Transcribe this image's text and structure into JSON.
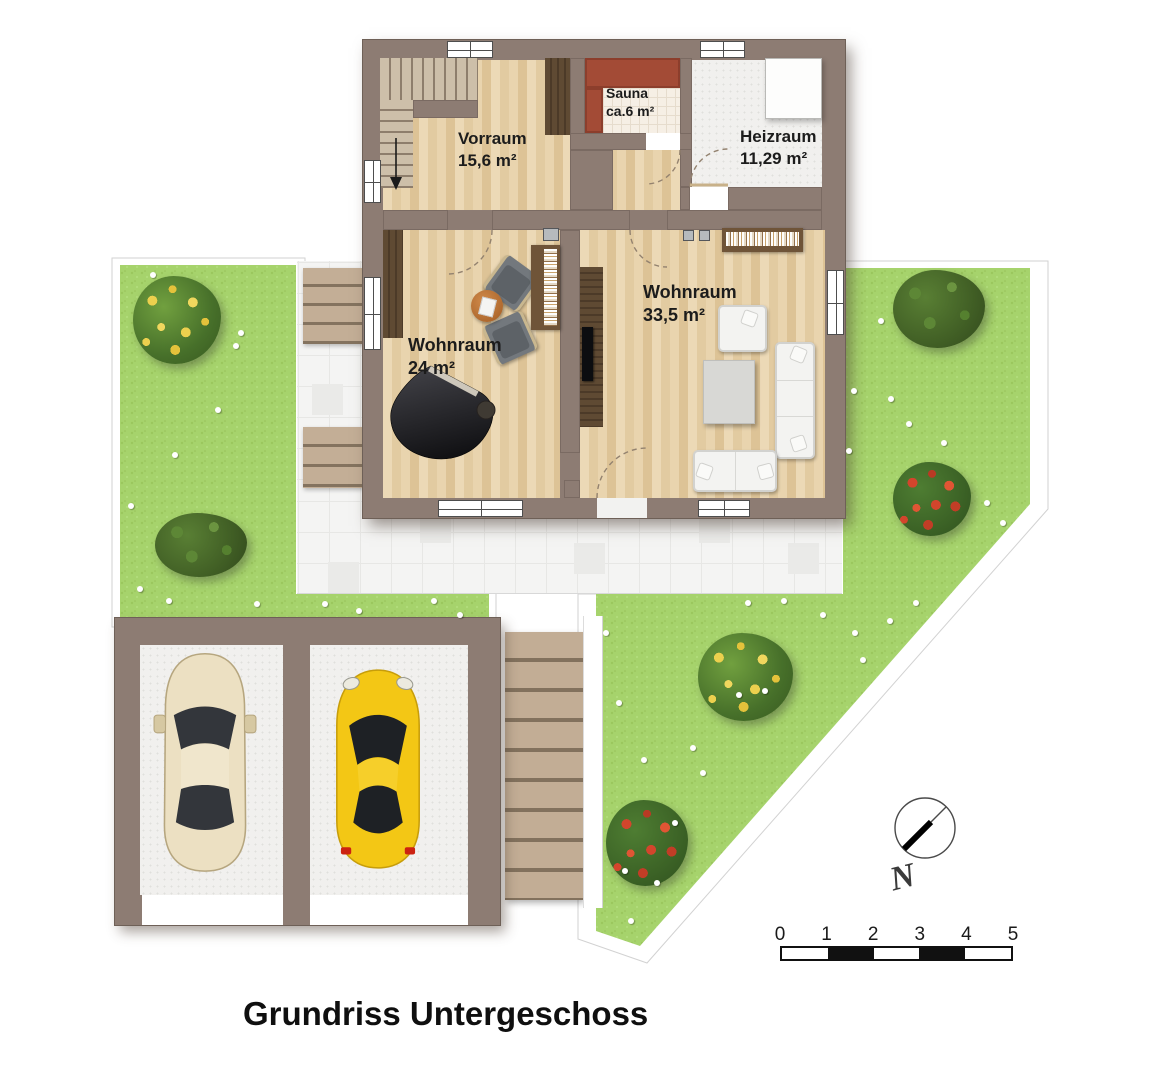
{
  "title": "Grundriss Untergeschoss",
  "rooms": [
    {
      "name": "Vorraum",
      "area": "15,6 m²"
    },
    {
      "name": "Sauna",
      "area": "ca.6 m²"
    },
    {
      "name": "Heizraum",
      "area": "11,29 m²"
    },
    {
      "name": "Wohnraum",
      "area": "24 m²"
    },
    {
      "name": "Wohnraum",
      "area": "33,5 m²"
    }
  ],
  "compass": {
    "label": "N"
  },
  "scale_bar": {
    "ticks": [
      "0",
      "1",
      "2",
      "3",
      "4",
      "5"
    ],
    "segment_colors": [
      "#ffffff",
      "#111111",
      "#ffffff",
      "#111111",
      "#ffffff"
    ]
  },
  "objects": {
    "furniture": [
      "staircase",
      "wardrobe",
      "sauna-bench",
      "boiler",
      "grand-piano",
      "piano-stool",
      "armchair-gray",
      "armchair-gray",
      "side-table",
      "bookshelf",
      "tv-panel",
      "armchair-white",
      "coffee-table",
      "sofa-3seat",
      "sofa-2seat",
      "bookshelf-wall"
    ],
    "garage_cars": [
      {
        "name": "beige-car",
        "color": "#ece0c2"
      },
      {
        "name": "yellow-car",
        "color": "#f3c715"
      }
    ],
    "landscape": [
      "flowering-bush-yellow",
      "bush-dark-green",
      "flowering-bush-red",
      "white-flowers"
    ]
  },
  "colors": {
    "wall": "#8d7c73",
    "wood_floor": "#e6d0a8",
    "lawn": "#a6d36c",
    "sauna_bench": "#a34b36",
    "tile_path": "#f4f4f3",
    "steps": "#c2ad95",
    "piano": "#111111",
    "scale_black": "#111111"
  }
}
